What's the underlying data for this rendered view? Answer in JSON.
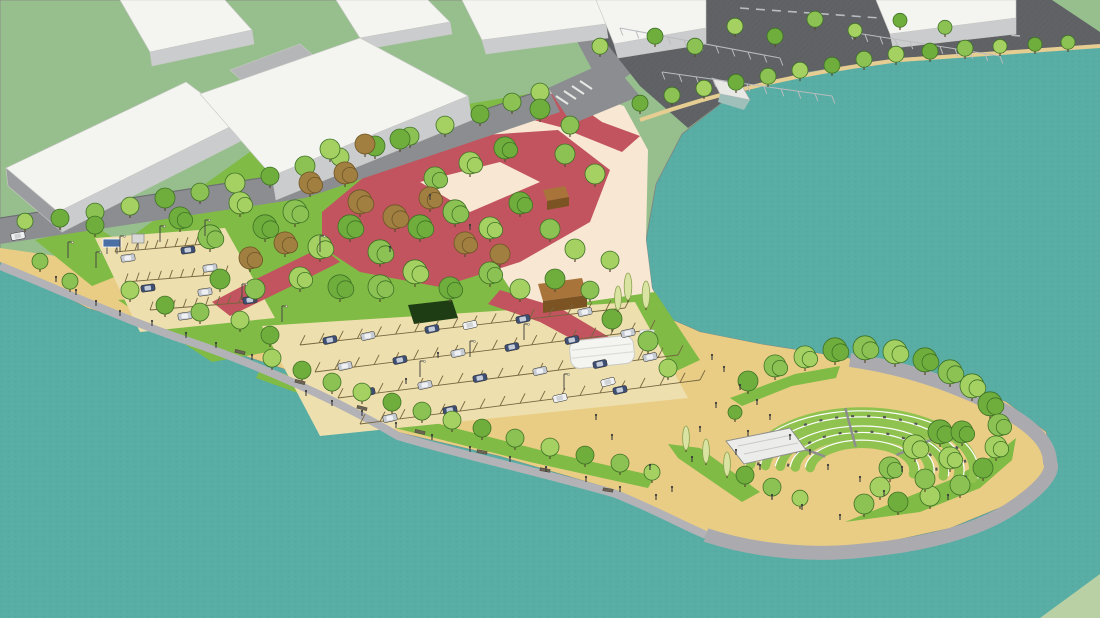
{
  "meta": {
    "title": "Aerial 3D rendering of a waterfront park master plan with amphitheater, parking lots, red plaza paths, tree groves and warehouse buildings"
  },
  "colors": {
    "water": "#58ada4",
    "waterDot1": "#4d9e96",
    "waterDot2": "#65b5ac",
    "grass": "#97bf8e",
    "grassFar": "#b9d0a4",
    "lawn": "#7fbb45",
    "lawnLight": "#a2d05e",
    "sandPale": "#f8e7d3",
    "sandGold": "#e9cd85",
    "lotTan": "#eedfae",
    "asphalt": "#606266",
    "asphaltLine": "#55575a",
    "stripe": "#b9bcbe",
    "road": "#8b8d90",
    "roadDark": "#6e7073",
    "shore": "#b3b3b7",
    "shoreWide": "#ababaf",
    "shoreSand": "#e6cd92",
    "red": "#c2545f",
    "roof": "#f4f5f1",
    "faceLight": "#cbccce",
    "face": "#b5b6b8",
    "faceDark": "#9b9c9f",
    "treeEdge": "#3f7226",
    "treeBrown": "#a07f41",
    "treeBrownEdge": "#6e5526",
    "treeDark": "#2f5b22",
    "poplar": "#d9e4a2",
    "poplarEdge": "#8aa14f",
    "trunk": "#5a4a30",
    "hedge": "#1f3d15",
    "kiosk": "#a8743a",
    "kioskDark": "#7c5424",
    "stage": "#ececea",
    "stageEdge": "#8f8f8b",
    "tier": "#8fc24e",
    "tierLine": "#ffffff",
    "bench": "#555555",
    "stepGray": "#8e8e8e",
    "sign": "#4a6fa5",
    "figure": "#3a3a3a",
    "pole": "#4a4a44",
    "carNavy": "#3e4f73",
    "carSilver": "#c7ccd3",
    "carWhite": "#eff1f2",
    "stallLine": "#77663f",
    "benchSeat": "#6b6354",
    "benchEdge": "#4a4538"
  },
  "scene": {
    "tree_greens": [
      "#6fae3c",
      "#8cc253",
      "#a5d162"
    ],
    "trees": [
      [
        60,
        228,
        9,
        "g"
      ],
      [
        95,
        222,
        9,
        "g"
      ],
      [
        130,
        216,
        9,
        "g"
      ],
      [
        165,
        209,
        10,
        "g"
      ],
      [
        200,
        202,
        9,
        "g"
      ],
      [
        235,
        194,
        10,
        "g"
      ],
      [
        270,
        186,
        9,
        "g"
      ],
      [
        305,
        177,
        10,
        "g"
      ],
      [
        340,
        167,
        9,
        "g"
      ],
      [
        375,
        157,
        10,
        "g"
      ],
      [
        410,
        146,
        9,
        "g"
      ],
      [
        445,
        135,
        9,
        "g"
      ],
      [
        480,
        124,
        9,
        "g"
      ],
      [
        512,
        112,
        9,
        "g"
      ],
      [
        540,
        102,
        9,
        "g"
      ],
      [
        180,
        230,
        11,
        "g"
      ],
      [
        210,
        250,
        12,
        "g"
      ],
      [
        240,
        215,
        11,
        "g"
      ],
      [
        265,
        240,
        12,
        "g"
      ],
      [
        295,
        225,
        12,
        "g"
      ],
      [
        320,
        260,
        12,
        "g"
      ],
      [
        350,
        240,
        12,
        "g"
      ],
      [
        380,
        265,
        12,
        "g"
      ],
      [
        300,
        290,
        11,
        "g"
      ],
      [
        340,
        300,
        12,
        "g"
      ],
      [
        380,
        300,
        12,
        "g"
      ],
      [
        415,
        285,
        12,
        "g"
      ],
      [
        450,
        300,
        11,
        "g"
      ],
      [
        490,
        285,
        11,
        "g"
      ],
      [
        520,
        300,
        10,
        "g"
      ],
      [
        420,
        240,
        12,
        "g"
      ],
      [
        455,
        225,
        12,
        "g"
      ],
      [
        490,
        240,
        11,
        "g"
      ],
      [
        520,
        215,
        11,
        "g"
      ],
      [
        550,
        240,
        10,
        "g"
      ],
      [
        575,
        260,
        10,
        "g"
      ],
      [
        555,
        290,
        10,
        "g"
      ],
      [
        590,
        300,
        9,
        "g"
      ],
      [
        610,
        270,
        9,
        "g"
      ],
      [
        220,
        290,
        10,
        "g"
      ],
      [
        255,
        300,
        10,
        "g"
      ],
      [
        330,
        160,
        10,
        "g"
      ],
      [
        400,
        150,
        10,
        "g"
      ],
      [
        435,
        190,
        11,
        "g"
      ],
      [
        470,
        175,
        11,
        "g"
      ],
      [
        505,
        160,
        11,
        "g"
      ],
      [
        565,
        165,
        10,
        "g"
      ],
      [
        595,
        185,
        10,
        "g"
      ],
      [
        540,
        120,
        10,
        "g"
      ],
      [
        570,
        135,
        9,
        "g"
      ],
      [
        250,
        270,
        11,
        "b"
      ],
      [
        285,
        255,
        11,
        "b"
      ],
      [
        360,
        215,
        12,
        "b"
      ],
      [
        395,
        230,
        12,
        "b"
      ],
      [
        430,
        210,
        11,
        "b"
      ],
      [
        465,
        255,
        11,
        "b"
      ],
      [
        500,
        265,
        10,
        "b"
      ],
      [
        310,
        195,
        11,
        "b"
      ],
      [
        345,
        185,
        11,
        "b"
      ],
      [
        365,
        155,
        10,
        "b"
      ],
      [
        640,
        112,
        8,
        "g"
      ],
      [
        672,
        104,
        8,
        "g"
      ],
      [
        704,
        97,
        8,
        "g"
      ],
      [
        736,
        91,
        8,
        "g"
      ],
      [
        768,
        85,
        8,
        "g"
      ],
      [
        800,
        79,
        8,
        "g"
      ],
      [
        832,
        74,
        8,
        "g"
      ],
      [
        864,
        68,
        8,
        "g"
      ],
      [
        896,
        63,
        8,
        "g"
      ],
      [
        930,
        60,
        8,
        "g"
      ],
      [
        965,
        57,
        8,
        "g"
      ],
      [
        1000,
        54,
        7,
        "g"
      ],
      [
        1035,
        52,
        7,
        "g"
      ],
      [
        1068,
        50,
        7,
        "g"
      ],
      [
        600,
        55,
        8,
        "g"
      ],
      [
        655,
        45,
        8,
        "g"
      ],
      [
        695,
        55,
        8,
        "g"
      ],
      [
        735,
        35,
        8,
        "g"
      ],
      [
        775,
        45,
        8,
        "g"
      ],
      [
        815,
        28,
        8,
        "g"
      ],
      [
        855,
        38,
        7,
        "g"
      ],
      [
        900,
        28,
        7,
        "g"
      ],
      [
        945,
        35,
        7,
        "g"
      ],
      [
        272,
        368,
        9,
        "g"
      ],
      [
        302,
        380,
        9,
        "g"
      ],
      [
        332,
        392,
        9,
        "g"
      ],
      [
        362,
        402,
        9,
        "g"
      ],
      [
        392,
        412,
        9,
        "g"
      ],
      [
        422,
        421,
        9,
        "g"
      ],
      [
        452,
        430,
        9,
        "g"
      ],
      [
        482,
        438,
        9,
        "g"
      ],
      [
        515,
        448,
        9,
        "g"
      ],
      [
        550,
        457,
        9,
        "g"
      ],
      [
        585,
        465,
        9,
        "g"
      ],
      [
        620,
        473,
        9,
        "g"
      ],
      [
        652,
        481,
        8,
        "g"
      ],
      [
        95,
        235,
        9,
        "g"
      ],
      [
        70,
        290,
        8,
        "g"
      ],
      [
        130,
        300,
        9,
        "g"
      ],
      [
        165,
        315,
        9,
        "g"
      ],
      [
        200,
        322,
        9,
        "g"
      ],
      [
        240,
        330,
        9,
        "g"
      ],
      [
        270,
        345,
        9,
        "g"
      ],
      [
        40,
        270,
        8,
        "g"
      ],
      [
        25,
        230,
        8,
        "g"
      ],
      [
        612,
        330,
        10,
        "g"
      ],
      [
        648,
        352,
        10,
        "g"
      ],
      [
        668,
        378,
        9,
        "g"
      ],
      [
        748,
        392,
        10,
        "g"
      ],
      [
        775,
        378,
        11,
        "g"
      ],
      [
        805,
        369,
        11,
        "g"
      ],
      [
        835,
        363,
        12,
        "g"
      ],
      [
        865,
        361,
        12,
        "g"
      ],
      [
        895,
        365,
        12,
        "g"
      ],
      [
        925,
        373,
        12,
        "g"
      ],
      [
        950,
        385,
        12,
        "g"
      ],
      [
        972,
        399,
        12,
        "g"
      ],
      [
        990,
        417,
        12,
        "g"
      ],
      [
        999,
        437,
        11,
        "g"
      ],
      [
        996,
        459,
        11,
        "g"
      ],
      [
        983,
        479,
        10,
        "g"
      ],
      [
        960,
        496,
        10,
        "g"
      ],
      [
        930,
        507,
        10,
        "g"
      ],
      [
        898,
        513,
        10,
        "g"
      ],
      [
        864,
        515,
        10,
        "g"
      ],
      [
        915,
        460,
        12,
        "g"
      ],
      [
        940,
        445,
        12,
        "g"
      ],
      [
        890,
        480,
        11,
        "g"
      ],
      [
        950,
        470,
        11,
        "g"
      ],
      [
        962,
        444,
        11,
        "g"
      ],
      [
        925,
        490,
        10,
        "g"
      ],
      [
        880,
        498,
        10,
        "g"
      ],
      [
        745,
        485,
        9,
        "g"
      ],
      [
        772,
        497,
        9,
        "g"
      ],
      [
        800,
        507,
        8,
        "g"
      ],
      [
        735,
        420,
        7,
        "g"
      ],
      [
        628,
        300,
        9,
        "p"
      ],
      [
        646,
        308,
        9,
        "p"
      ],
      [
        618,
        310,
        8,
        "p"
      ],
      [
        686,
        450,
        8,
        "p"
      ],
      [
        706,
        463,
        8,
        "p"
      ],
      [
        727,
        476,
        8,
        "p"
      ]
    ],
    "cars": [
      [
        330,
        340,
        -12,
        "n"
      ],
      [
        368,
        336,
        -12,
        "s"
      ],
      [
        432,
        329,
        -12,
        "n"
      ],
      [
        470,
        325,
        -12,
        "w"
      ],
      [
        523,
        319,
        -12,
        "n"
      ],
      [
        585,
        312,
        -12,
        "s"
      ],
      [
        345,
        366,
        -12,
        "s"
      ],
      [
        400,
        360,
        -12,
        "n"
      ],
      [
        458,
        353,
        -12,
        "s"
      ],
      [
        512,
        347,
        -12,
        "n"
      ],
      [
        572,
        340,
        -12,
        "n"
      ],
      [
        628,
        333,
        -12,
        "s"
      ],
      [
        368,
        392,
        -12,
        "n"
      ],
      [
        425,
        385,
        -12,
        "s"
      ],
      [
        480,
        378,
        -12,
        "n"
      ],
      [
        540,
        371,
        -12,
        "s"
      ],
      [
        600,
        364,
        -12,
        "n"
      ],
      [
        650,
        357,
        -12,
        "s"
      ],
      [
        390,
        418,
        -12,
        "s"
      ],
      [
        450,
        410,
        -12,
        "n"
      ],
      [
        560,
        398,
        -12,
        "w"
      ],
      [
        620,
        390,
        -12,
        "n"
      ],
      [
        128,
        258,
        -8,
        "s"
      ],
      [
        188,
        250,
        -8,
        "n"
      ],
      [
        210,
        268,
        -8,
        "s"
      ],
      [
        148,
        288,
        -8,
        "n"
      ],
      [
        205,
        292,
        -8,
        "s"
      ],
      [
        250,
        300,
        -8,
        "n"
      ],
      [
        185,
        316,
        -8,
        "s"
      ],
      [
        18,
        236,
        -10,
        "w"
      ],
      [
        608,
        382,
        -15,
        "w"
      ]
    ],
    "people": [
      [
        712,
        360
      ],
      [
        724,
        372
      ],
      [
        740,
        390
      ],
      [
        757,
        405
      ],
      [
        770,
        420
      ],
      [
        790,
        440
      ],
      [
        810,
        455
      ],
      [
        828,
        470
      ],
      [
        760,
        470
      ],
      [
        736,
        455
      ],
      [
        700,
        432
      ],
      [
        692,
        462
      ],
      [
        860,
        482
      ],
      [
        884,
        496
      ],
      [
        902,
        472
      ],
      [
        948,
        500
      ],
      [
        840,
        520
      ],
      [
        802,
        510
      ],
      [
        772,
        500
      ],
      [
        716,
        408
      ],
      [
        748,
        436
      ],
      [
        306,
        396
      ],
      [
        332,
        406
      ],
      [
        362,
        416
      ],
      [
        396,
        428
      ],
      [
        432,
        440
      ],
      [
        470,
        452
      ],
      [
        510,
        462
      ],
      [
        546,
        472
      ],
      [
        586,
        482
      ],
      [
        620,
        492
      ],
      [
        656,
        500
      ],
      [
        56,
        282
      ],
      [
        76,
        295
      ],
      [
        96,
        306
      ],
      [
        120,
        316
      ],
      [
        152,
        326
      ],
      [
        186,
        338
      ],
      [
        216,
        348
      ],
      [
        252,
        360
      ],
      [
        430,
        200
      ],
      [
        470,
        230
      ],
      [
        390,
        252
      ],
      [
        438,
        358
      ],
      [
        406,
        384
      ],
      [
        596,
        420
      ],
      [
        612,
        440
      ],
      [
        650,
        470
      ],
      [
        672,
        492
      ]
    ],
    "poles": [
      [
        68,
        258
      ],
      [
        96,
        268
      ],
      [
        120,
        252
      ],
      [
        160,
        242
      ],
      [
        205,
        236
      ],
      [
        242,
        300
      ],
      [
        282,
        322
      ],
      [
        320,
        252
      ],
      [
        420,
        377
      ],
      [
        470,
        357
      ],
      [
        524,
        340
      ],
      [
        564,
        390
      ]
    ],
    "benches": [
      [
        240,
        352,
        15
      ],
      [
        300,
        382,
        15
      ],
      [
        362,
        408,
        14
      ],
      [
        420,
        432,
        13
      ],
      [
        482,
        452,
        12
      ],
      [
        545,
        470,
        10
      ],
      [
        608,
        490,
        9
      ]
    ],
    "stall_rows": {
      "center": {
        "rows": [
          [
            300,
            345,
            625,
            308
          ],
          [
            315,
            372,
            650,
            330
          ],
          [
            338,
            398,
            678,
            355
          ],
          [
            360,
            424,
            700,
            380
          ]
        ],
        "n": 17,
        "tick": [
          5,
          -9.8
        ]
      },
      "left": {
        "rows": [
          [
            115,
            252,
            205,
            244
          ],
          [
            125,
            282,
            225,
            274
          ],
          [
            150,
            310,
            250,
            302
          ]
        ],
        "n": 9,
        "tick": [
          3,
          -8.5
        ]
      },
      "asphalt": {
        "rows": [
          [
            620,
            28,
            780,
            58
          ],
          [
            662,
            72,
            832,
            96
          ],
          [
            850,
            32,
            1000,
            56
          ]
        ],
        "n": 10,
        "tick": [
          2.8,
          7.5
        ]
      }
    },
    "amphitheater": {
      "cx": 862,
      "cy": 470,
      "ratio": 0.52,
      "tiers": [
        112,
        97,
        82,
        67,
        52
      ],
      "start_deg": 185,
      "end_deg": 368,
      "bench_radii": [
        74.5,
        104.5
      ],
      "step_degs": [
        215,
        262,
        320
      ]
    }
  }
}
